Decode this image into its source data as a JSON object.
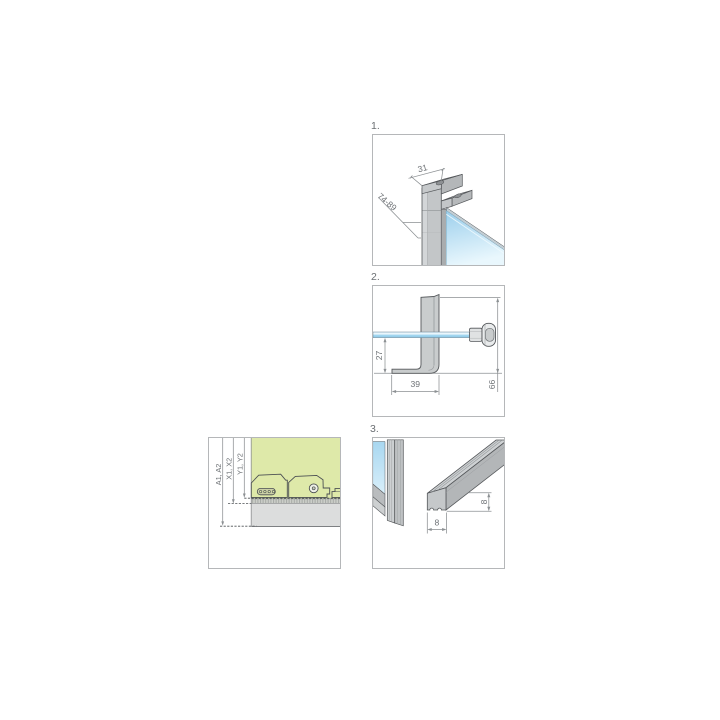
{
  "steps": {
    "step1": {
      "label": "1.",
      "dim_profile_width": "31",
      "dim_adjust_range": "74-89"
    },
    "step2": {
      "label": "2.",
      "dim_bracket_height": "27",
      "dim_foot_depth": "39",
      "dim_total_height": "66"
    },
    "step3": {
      "label": "3.",
      "dim_threshold_width": "8",
      "dim_threshold_height": "8"
    },
    "adjustment": {
      "dim_a": "A1, A2",
      "dim_x": "X1, X2",
      "dim_y": "Y1, Y2"
    }
  },
  "colors": {
    "glass_blue": "#9ccfec",
    "profile_gray": "#c3c6c8",
    "accent_green": "#dee9a9",
    "outline": "#54575a",
    "dimension": "#8c9093"
  }
}
